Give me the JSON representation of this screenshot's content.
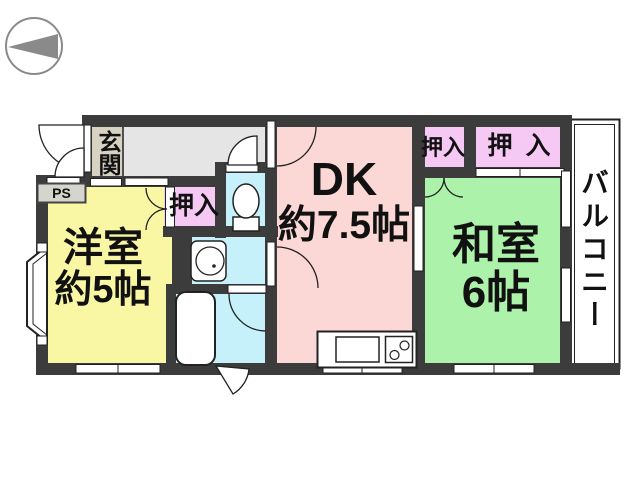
{
  "compass": {
    "icon": "compass-arrow",
    "direction": "west"
  },
  "floor_plan": {
    "entrance": {
      "label": "玄関"
    },
    "pipe_space": {
      "label": "PS"
    },
    "western_room": {
      "name": "洋室",
      "size": "約5帖"
    },
    "dining_kitchen": {
      "name": "DK",
      "size": "約7.5帖"
    },
    "japanese_room": {
      "name": "和室",
      "size": "6帖"
    },
    "closet_west": {
      "label": "押入"
    },
    "closet_north_1": {
      "label": "押入"
    },
    "closet_north_2": {
      "label": "押入"
    },
    "balcony": {
      "label": "バルコニー"
    },
    "fixtures": [
      "toilet",
      "washbasin",
      "bathtub",
      "kitchen-sink",
      "stove",
      "bay-window"
    ]
  },
  "colors": {
    "wall": "#3c3c3c",
    "western_room": "#f9f6a4",
    "dining_kitchen": "#fbd8d5",
    "japanese_room": "#adf2aa",
    "closet": "#f6c9f4",
    "wet_area": "#c6f0fa",
    "entrance": "#d8d2c2",
    "hallway": "#e5e5e5",
    "pipe_space_box": "#d5d5cd",
    "compass": "#8a8a8a"
  }
}
